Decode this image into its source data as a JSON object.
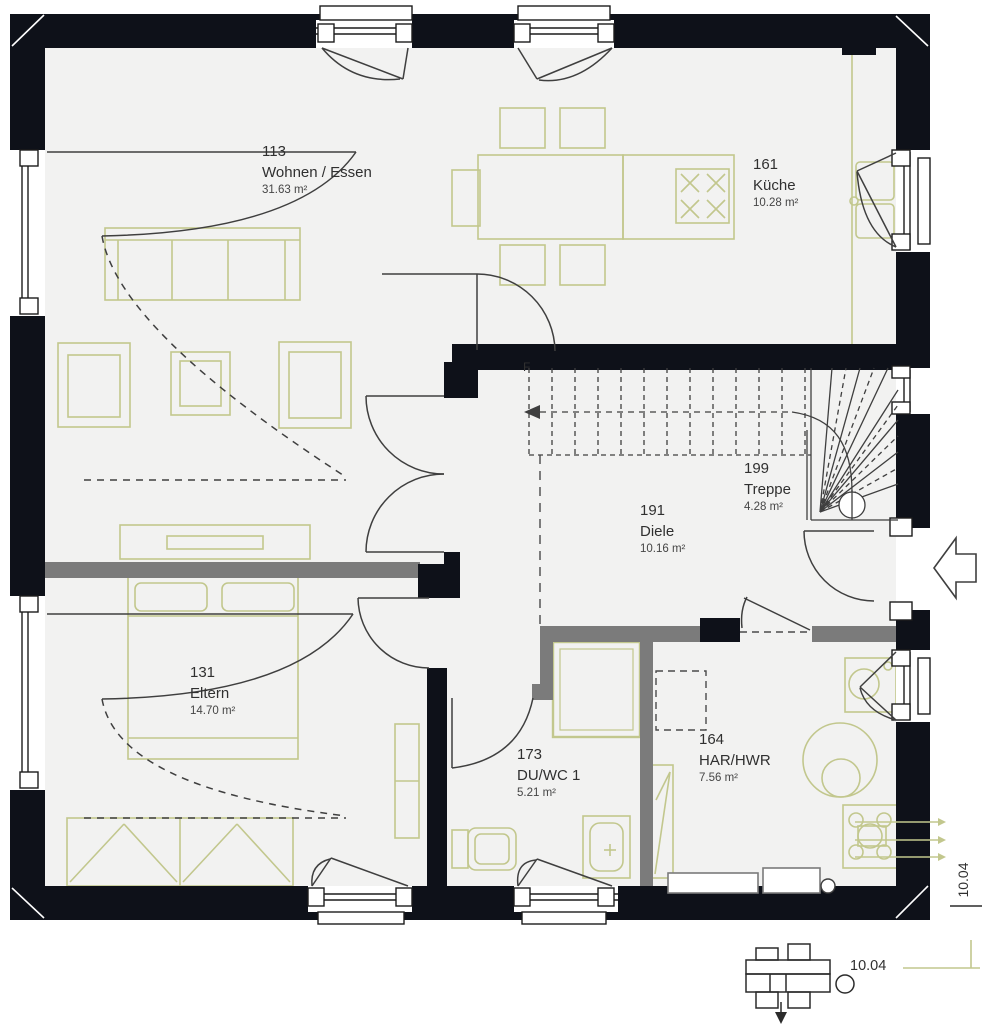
{
  "plan": {
    "rooms": [
      {
        "id": "113",
        "name": "Wohnen / Essen",
        "area": "31.63 m²"
      },
      {
        "id": "161",
        "name": "Küche",
        "area": "10.28 m²"
      },
      {
        "id": "199",
        "name": "Treppe",
        "area": "4.28 m²"
      },
      {
        "id": "191",
        "name": "Diele",
        "area": "10.16 m²"
      },
      {
        "id": "131",
        "name": "Eltern",
        "area": "14.70 m²"
      },
      {
        "id": "173",
        "name": "DU/WC 1",
        "area": "5.21 m²"
      },
      {
        "id": "164",
        "name": "HAR/HWR",
        "area": "7.56 m²"
      }
    ],
    "stair_mark": "F",
    "dimensions": {
      "right_edge": "10.04",
      "detail": "10.04"
    },
    "colors": {
      "exterior_wall": "#0e1119",
      "partition": "#7b7b7b",
      "furniture": "#c2c78d",
      "floor": "#f2f2f1",
      "line": "#3f3f3f"
    }
  }
}
